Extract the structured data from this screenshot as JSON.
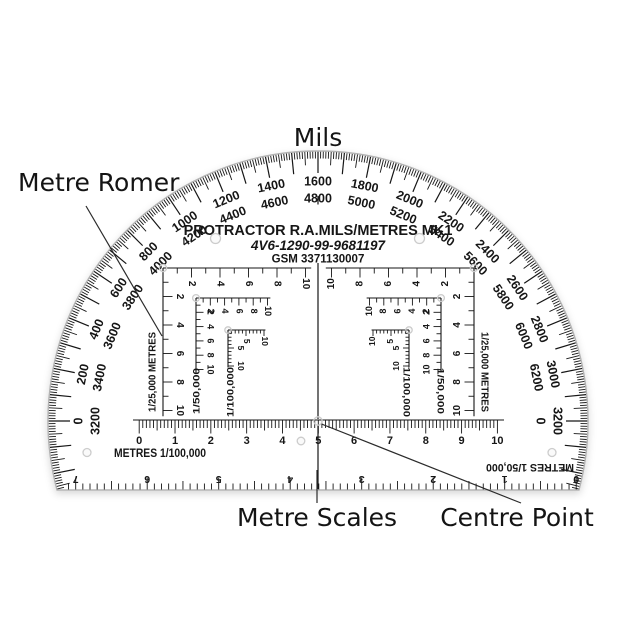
{
  "captions": {
    "mils": "Mils",
    "metre_romer": "Metre Romer",
    "metre_scales": "Metre Scales",
    "centre_point": "Centre Point"
  },
  "protractor": {
    "title_line1": "PROTRACTOR R.A.MILS/METRES MK1",
    "title_line2": "4V6-1290-99-9681197",
    "title_line3": "GSM 3371130007",
    "mils": {
      "label_pairs": [
        [
          "0",
          "3200"
        ],
        [
          "200",
          "3400"
        ],
        [
          "400",
          "3600"
        ],
        [
          "600",
          "3800"
        ],
        [
          "800",
          "4000"
        ],
        [
          "1000",
          "4200"
        ],
        [
          "1200",
          "4400"
        ],
        [
          "1400",
          "4600"
        ],
        [
          "1600",
          "4800"
        ],
        [
          "1800",
          "5000"
        ],
        [
          "2000",
          "5200"
        ],
        [
          "2200",
          "5400"
        ],
        [
          "2400",
          "5600"
        ],
        [
          "2600",
          "5800"
        ],
        [
          "2800",
          "6000"
        ],
        [
          "3000",
          "6200"
        ],
        [
          "3200",
          "0"
        ]
      ]
    },
    "romers": [
      {
        "label": "1/25,000 METRES",
        "numbers": [
          "2",
          "4",
          "6",
          "8",
          "10"
        ]
      },
      {
        "label": "1/50,000",
        "numbers": [
          "2",
          "4",
          "6",
          "8",
          "10"
        ]
      },
      {
        "label": "1/100,000",
        "numbers": [
          "5",
          "10"
        ]
      }
    ],
    "bottom_ruler": {
      "label": "METRES 1/100,000",
      "numbers": [
        "0",
        "1",
        "2",
        "3",
        "4",
        "5",
        "6",
        "7",
        "8",
        "9",
        "10"
      ]
    },
    "edge_ruler": {
      "label": "METRES 1/50,000",
      "numbers": [
        "0",
        "1",
        "2",
        "3",
        "4",
        "5",
        "6",
        "7"
      ]
    }
  },
  "colors": {
    "ink": "#161616",
    "caption": "#141414",
    "edge": "#b3b3b3",
    "body": "#ffffff",
    "background": "#ffffff",
    "pointer": "#2b2b2b",
    "hole": "#cccccc"
  }
}
